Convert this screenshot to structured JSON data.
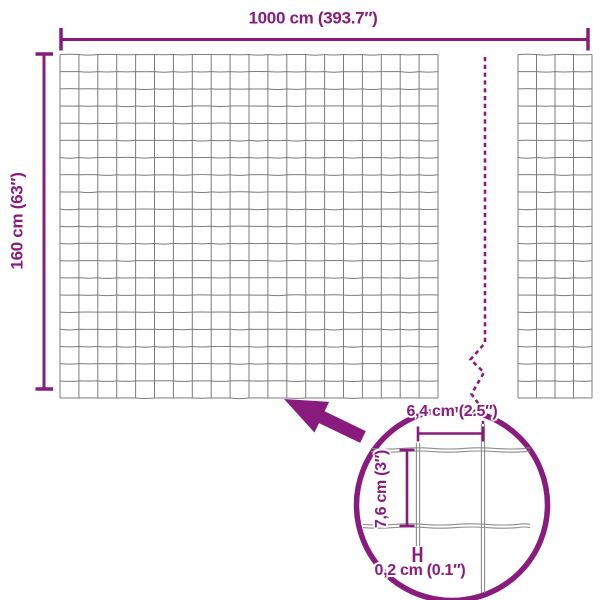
{
  "main_view": {
    "width_label": "1000 cm (393.7″)",
    "height_label": "160 cm (63″)",
    "mesh": {
      "rows": 20,
      "cols_left_panel": 20,
      "cols_right_panel": 4
    }
  },
  "detail_view": {
    "opening_width_label": "6,4 cm (2.5″)",
    "opening_height_label": "7,6 cm (3″)",
    "wire_thickness_label": "0,2 cm (0.1″)"
  },
  "icons": {
    "zoom_arrow": "arrow-up-left-icon",
    "break_line": "dashed-break-line",
    "detail_circle": "magnifier-detail-circle"
  },
  "colors": {
    "accent": "#8a1b7e",
    "mesh_line": "#7c7c7c",
    "detail_wire": "#8d8d8d",
    "background": "#ffffff"
  }
}
